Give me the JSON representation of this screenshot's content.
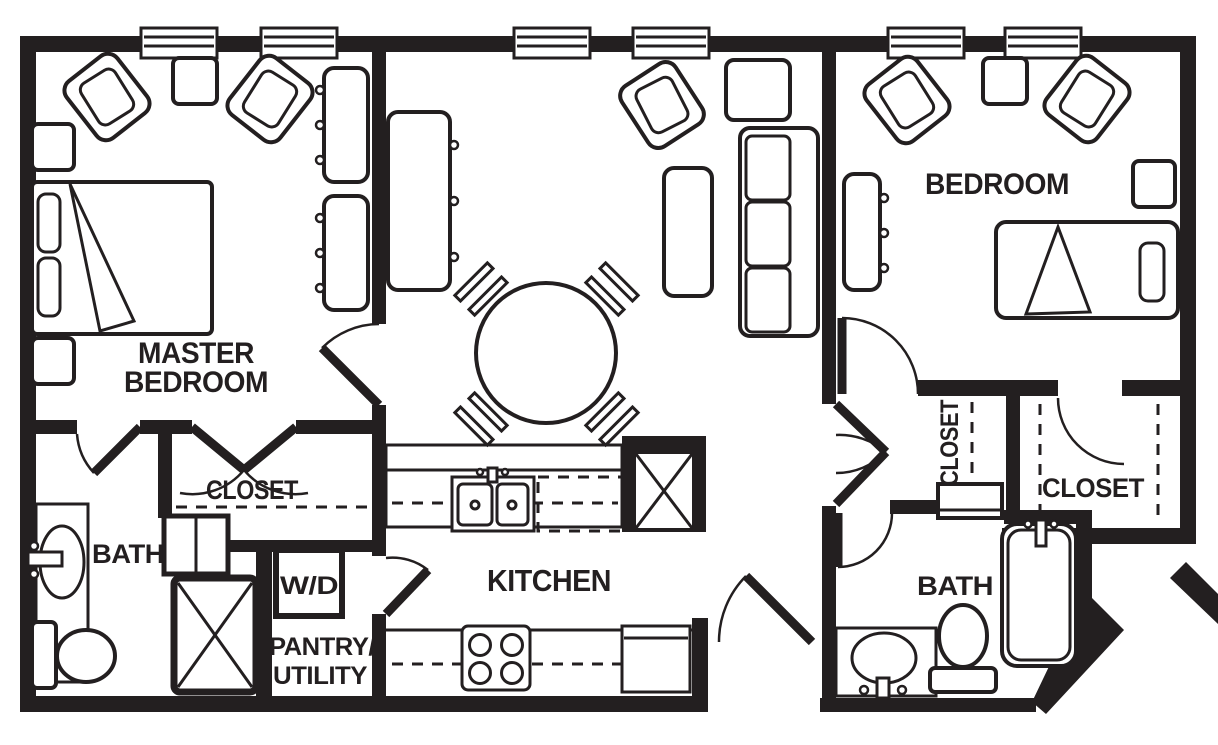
{
  "canvas": {
    "width": 1218,
    "height": 745,
    "background": "#ffffff",
    "ink": "#231f20"
  },
  "labels": {
    "master_bedroom_line1": "MASTER",
    "master_bedroom_line2": "BEDROOM",
    "master_closet": "CLOSET",
    "master_bath": "BATH",
    "washer_dryer": "W/D",
    "pantry_line1": "PANTRY/",
    "pantry_line2": "UTILITY",
    "kitchen": "KITCHEN",
    "bedroom": "BEDROOM",
    "hall_closet": "CLOSET",
    "bedroom_closet": "CLOSET",
    "bath": "BATH"
  },
  "symbols": [
    "window",
    "entry-door",
    "interior-door",
    "double-closet-doors",
    "closet-rod-dashed",
    "queen-bed",
    "twin-bed",
    "pillow",
    "armchair",
    "dining-table",
    "dining-chair",
    "sofa",
    "coffee-table",
    "side-table",
    "nightstand",
    "dresser",
    "media-console",
    "refrigerator",
    "range-stove",
    "oven",
    "double-sink",
    "dishwasher-dashed",
    "washer-dryer-niche",
    "shower-stall",
    "bathtub",
    "toilet",
    "vanity-sink",
    "linen-cabinet"
  ]
}
